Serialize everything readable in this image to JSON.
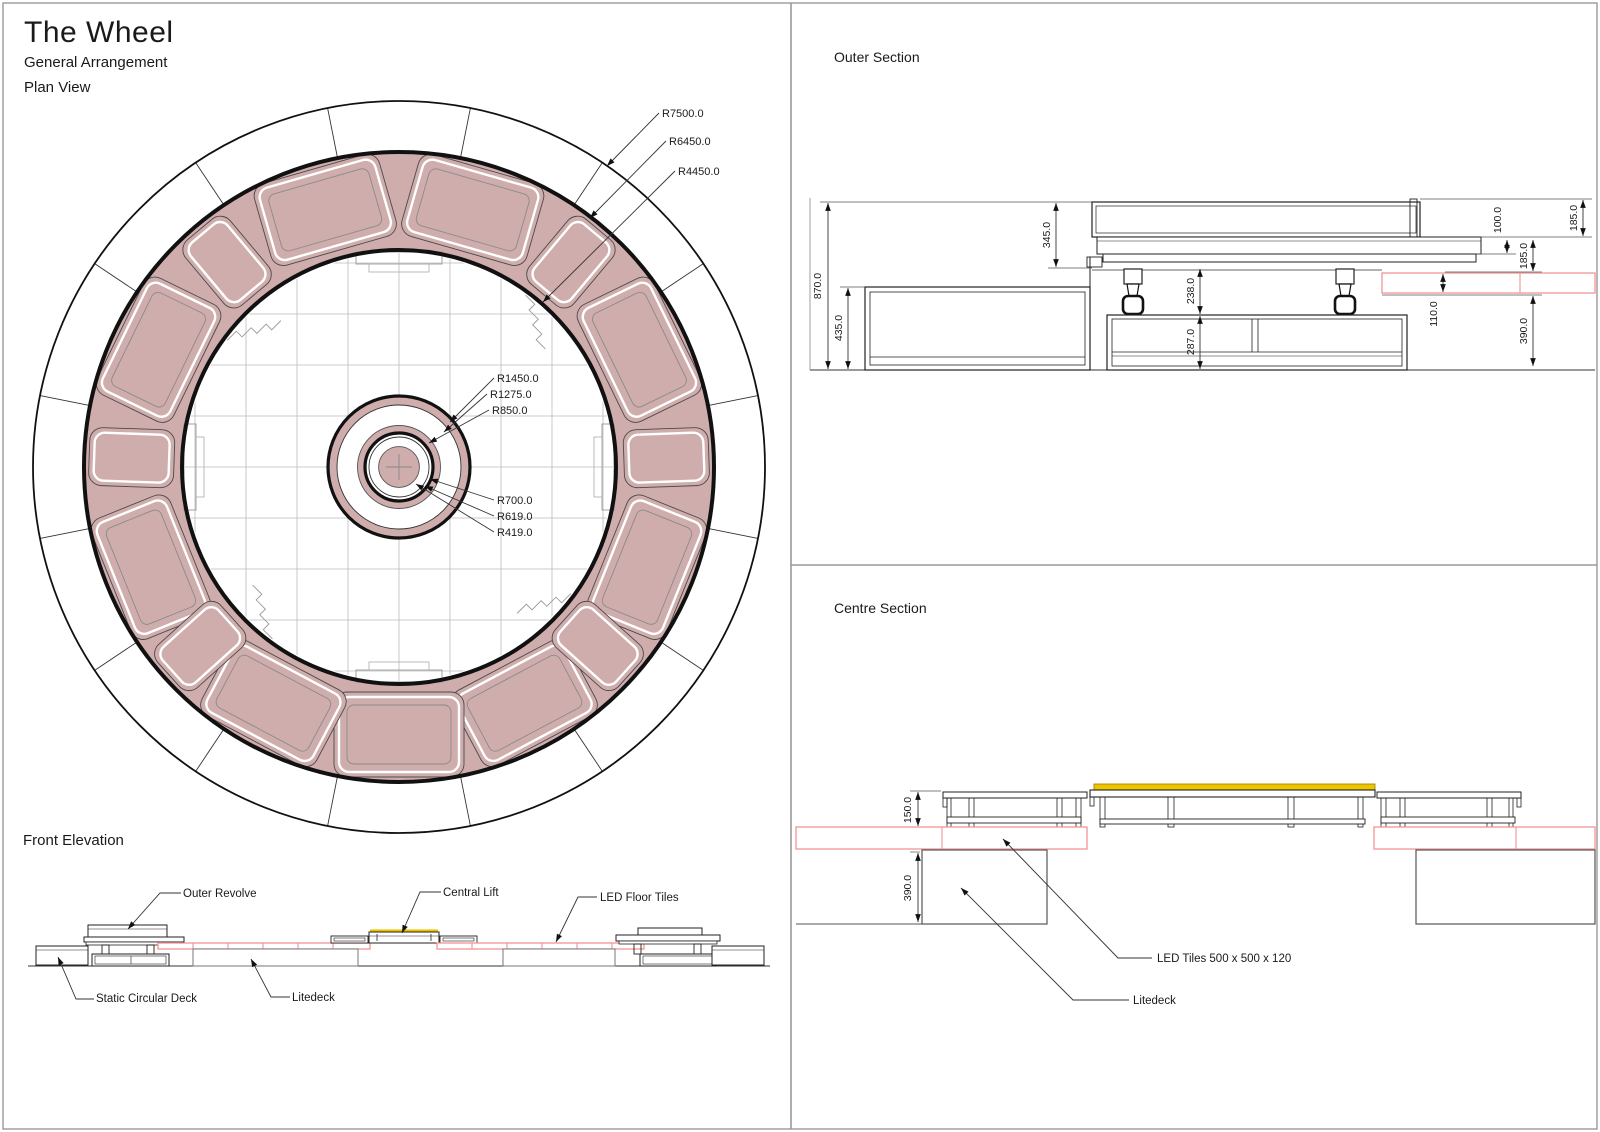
{
  "page": {
    "title": "The Wheel",
    "subtitle": "General Arrangement",
    "view": "Plan View"
  },
  "plan": {
    "radius_callouts": {
      "r7500": "R7500.0",
      "r6450": "R6450.0",
      "r4450": "R4450.0",
      "r1450": "R1450.0",
      "r1275": "R1275.0",
      "r850": "R850.0",
      "r700": "R700.0",
      "r619": "R619.0",
      "r419": "R419.0"
    },
    "pods": {
      "large_angles_deg": [
        16,
        64,
        112,
        152,
        180,
        208,
        248,
        296,
        344
      ],
      "small_angles_deg": [
        40,
        88,
        132,
        228,
        272,
        320
      ]
    }
  },
  "front_elevation": {
    "title": "Front Elevation",
    "labels": {
      "outer_revolve": "Outer Revolve",
      "central_lift": "Central Lift",
      "led_floor_tiles": "LED Floor Tiles",
      "static_circular_deck": "Static Circular Deck",
      "litedeck": "Litedeck"
    }
  },
  "outer_section": {
    "title": "Outer Section",
    "dims": {
      "total_height": "870.0",
      "deck_height": "435.0",
      "revolve_clearance": "345.0",
      "castor_space": "238.0",
      "frame_height": "287.0",
      "fascia_top": "100.0",
      "platform_upper": "185.0",
      "platform_lower": "185.0",
      "led_tile_height": "110.0",
      "substructure_height": "390.0"
    }
  },
  "centre_section": {
    "title": "Centre Section",
    "dims": {
      "platform_height": "150.0",
      "substructure_height": "390.0"
    },
    "labels": {
      "led_tiles": "LED Tiles 500 x 500 x 120",
      "litedeck": "Litedeck"
    }
  },
  "colors": {
    "pink": "#cfadad",
    "red": "#f09494",
    "yellow": "#ecc500",
    "line": "#1a1a1a",
    "gray": "#999999",
    "lightline": "#bababa"
  }
}
